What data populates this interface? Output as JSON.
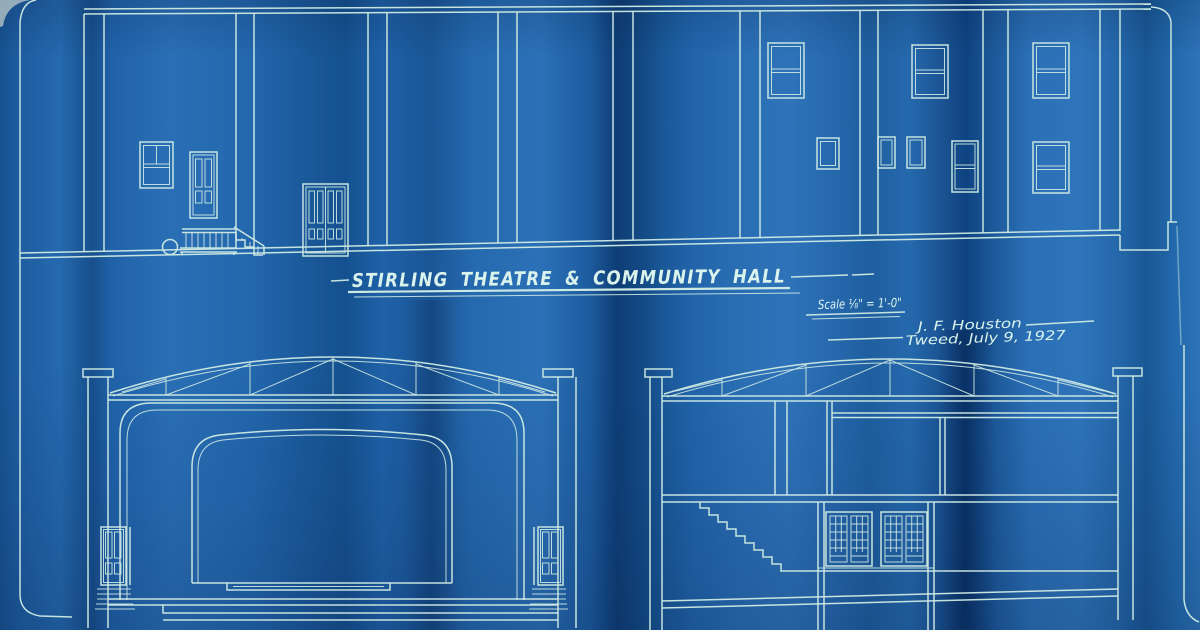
{
  "title": {
    "text": "STIRLING THEATRE & COMMUNITY HALL"
  },
  "notes": {
    "scale": "Scale ⅛\" = 1'-0\"",
    "architect": "J. F. Houston",
    "place_date": "Tweed, July 9, 1927"
  },
  "drawing": {
    "medium": "blueprint",
    "views": [
      {
        "label": "side-elevation"
      },
      {
        "label": "proscenium-cross-section"
      },
      {
        "label": "longitudinal-cross-section"
      }
    ]
  },
  "colors": {
    "paper_base": "#1f60a7",
    "fold_dark": "#0e4381",
    "fold_light": "#2f75bb",
    "line": "#cde9e3",
    "text": "#daf3ed"
  }
}
